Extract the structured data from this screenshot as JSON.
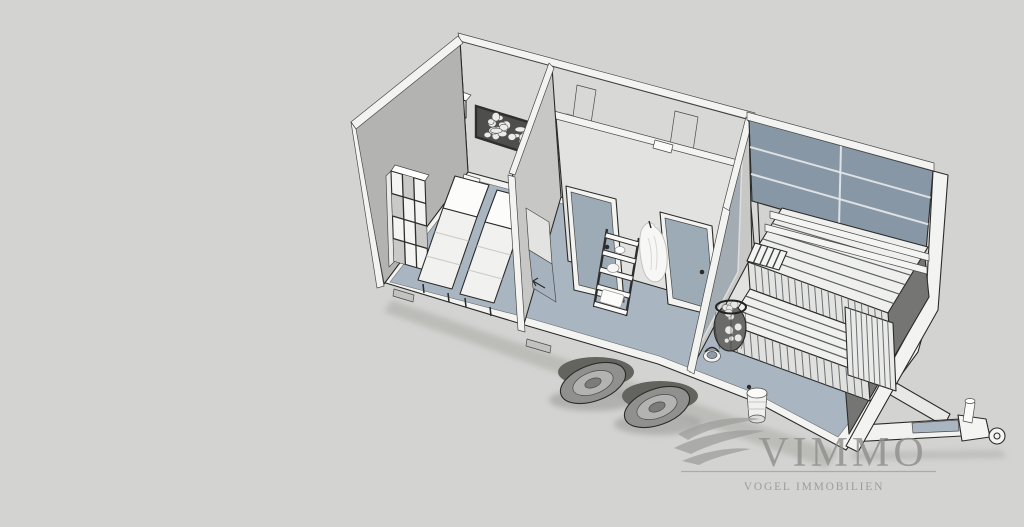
{
  "logo": {
    "brand": "VIMMO",
    "subtitle": "VOGEL IMMOBILIEN"
  },
  "palette": {
    "background": "#d3d3d1",
    "floor": "#a9b6c2",
    "floor_dark": "#94a1ad",
    "wall_bright": "#e2e2e0",
    "wall_light": "#d8d8d6",
    "wall_mid": "#c7c7c5",
    "wall_dark": "#b3b3b1",
    "edge_white": "#f3f3f1",
    "glass": "#8897a5",
    "door_panel": "#9dabb7",
    "outline": "#2b2b29",
    "bench": "#efefed",
    "wheel": "#90908e",
    "stone_panel": "#4e4e4c",
    "logo_gray": "#8f8f8d"
  },
  "scene": {
    "kind": "3D cutaway rendering of a mobile sauna trailer",
    "rooms": [
      "relaxation room",
      "changing room",
      "sauna"
    ],
    "objects": [
      "cube shelf",
      "wall unit",
      "pebble wall panel",
      "two loungers",
      "interior doors",
      "ladder shelf",
      "hanging robe",
      "sauna benches",
      "sauna heater",
      "buckets",
      "trailer wheels",
      "drawbar hitch"
    ]
  }
}
